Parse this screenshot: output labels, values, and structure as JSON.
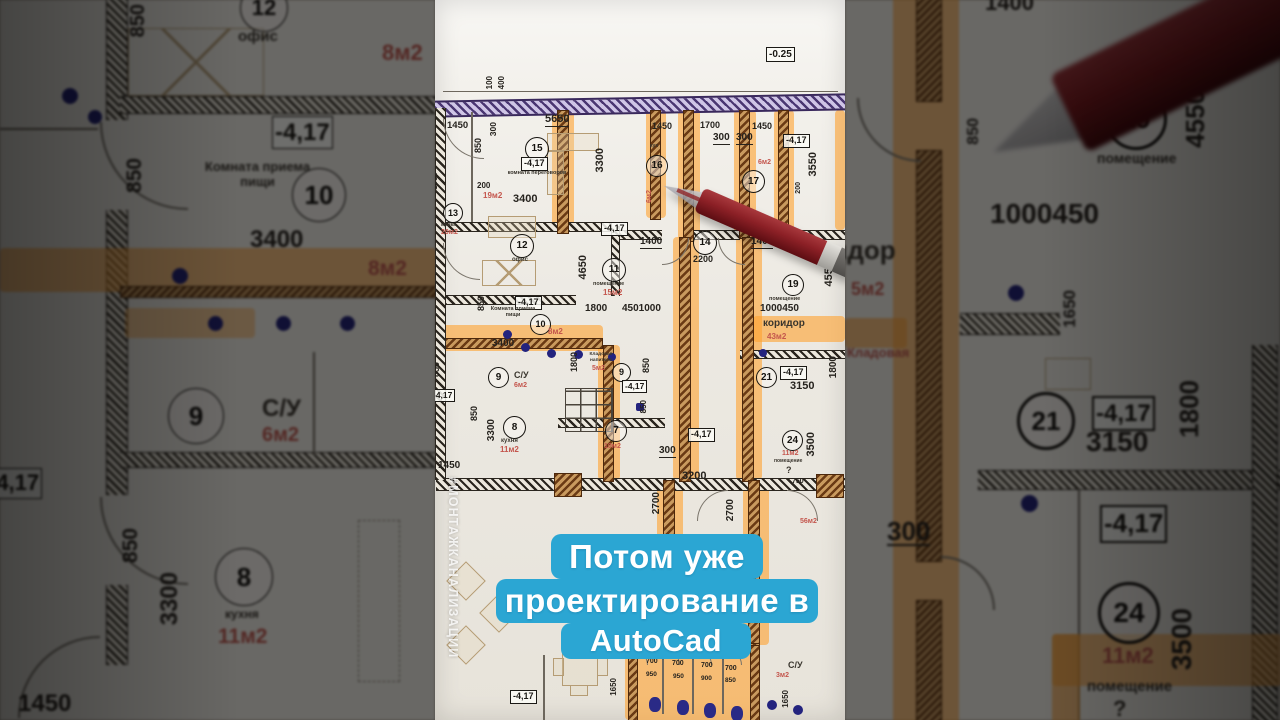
{
  "video": {
    "caption": {
      "line1": "Потом уже",
      "line2": "проектирование в",
      "line3": "AutoCad",
      "bg_color": "#2ba6d3",
      "text_color": "#ffffff"
    },
    "watermark": "#МОНТАЖКАНАЛИЗАЦИИ"
  },
  "plan": {
    "elevations": {
      "top": "-0.25",
      "floor": "-4,17"
    },
    "room_numbers": {
      "r7": "7",
      "r8": "8",
      "r9": "9",
      "r10": "10",
      "r11": "11",
      "r12": "12",
      "r13": "13",
      "r14": "14",
      "r15": "15",
      "r16": "16",
      "r17": "17",
      "r19": "19",
      "r21": "21",
      "r24": "24"
    },
    "room_labels": {
      "meeting": "комната переговоров",
      "office": "офис",
      "lunch": "Комната приема пищи",
      "corridor": "коридор",
      "pantry": "Кладовая напитков",
      "storage": "Кладовая",
      "wc": "С/У",
      "kitchen": "кухня",
      "room": "помещение",
      "sink_room": "мойка",
      "small_kitchen": "кух",
      "question": "?"
    },
    "areas": {
      "a3": "3м2",
      "a5": "5м2",
      "a6": "6м2",
      "a8": "8м2",
      "a10": "10м2",
      "a11": "11м2",
      "a15": "15м2",
      "a19": "19м2",
      "a20": "20м2",
      "a43": "43м2",
      "a56": "56м2"
    },
    "dims": {
      "d100": "100",
      "d200": "200",
      "d300": "300",
      "d400": "400",
      "d700": "700",
      "d750": "750",
      "d850": "850",
      "d900": "900",
      "d950": "950",
      "d1400": "1400",
      "d1450": "1450",
      "d1650": "1650",
      "d1700": "1700",
      "d1800": "1800",
      "d2200": "2200",
      "d2700": "2700",
      "d3150": "3150",
      "d3200": "3200",
      "d3300": "3300",
      "d3400": "3400",
      "d3500": "3500",
      "d3550": "3550",
      "d4550": "4550",
      "d4650": "4650",
      "d5650": "5650",
      "d45010": "4501000",
      "d100045": "1000450"
    }
  },
  "colors": {
    "highlight": "#ffa22e",
    "pen_body": "#8c2026",
    "wall_purple": "#4a3672",
    "paper": "#efece6"
  }
}
